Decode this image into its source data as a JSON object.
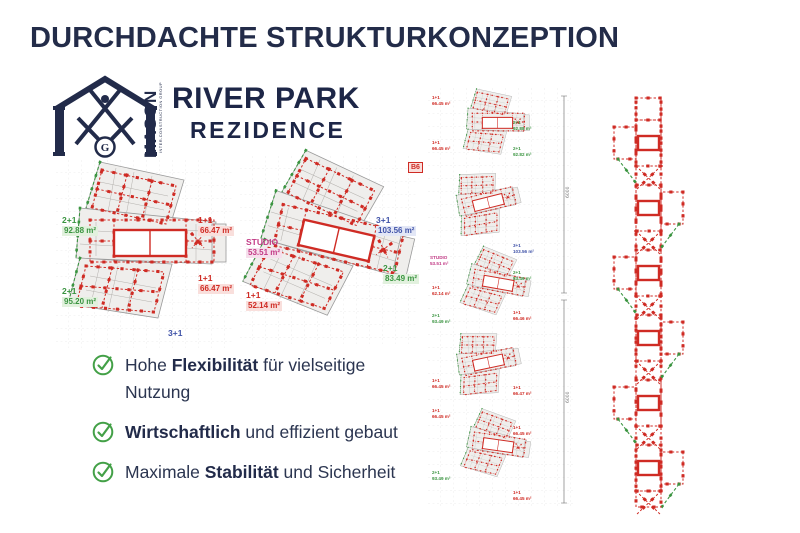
{
  "slide": {
    "title": "DURCHDACHTE STRUKTURKONZEPTION"
  },
  "logo": {
    "brand": "MASON",
    "tagline": "INTER-CONSTRUCTION GROUP",
    "emblem_letter": "G",
    "project": "RIVER PARK",
    "project_sub": "REZIDENCE"
  },
  "plans": {
    "left": {
      "labels": [
        {
          "unit": "2+1",
          "area": "92.88 m²"
        },
        {
          "unit": "1+1",
          "area": "66.47 m²"
        },
        {
          "unit": "2+1",
          "area": "95.20 m²"
        },
        {
          "unit": "1+1",
          "area": "66.47 m²"
        }
      ],
      "bottom_unit": "3+1"
    },
    "middle": {
      "badge": "B6",
      "labels": [
        {
          "unit": "3+1",
          "area": "103.56 m²"
        },
        {
          "unit": "STUDIO",
          "area": "53.51 m²"
        },
        {
          "unit": "2+1",
          "area": "83.49 m²"
        },
        {
          "unit": "1+1",
          "area": "52.14 m²"
        }
      ]
    }
  },
  "strip": {
    "labels": [
      {
        "text": "1+1\n66.45 m²"
      },
      {
        "text": "1+1\n66.45 m²"
      },
      {
        "text": "STUDIO\n53.51 m²"
      },
      {
        "text": "1+1\n62.14 m²"
      },
      {
        "text": "2+1\n93.49 m²"
      },
      {
        "text": "1+1\n66.45 m²"
      },
      {
        "text": "1+1\n66.45 m²"
      },
      {
        "text": "2+1\n93.49 m²"
      },
      {
        "text": "2+1\n92.88 m²"
      },
      {
        "text": "2+1\n92.82 m²"
      },
      {
        "text": "3+1\n103.56 m²"
      },
      {
        "text": "2+1\n83.49 m²"
      },
      {
        "text": "1+1\n66.46 m²"
      },
      {
        "text": "1+1\n66.47 m²"
      },
      {
        "text": "1+1\n66.45 m²"
      },
      {
        "text": "1+1\n66.45 m²"
      }
    ],
    "dimensions": [
      "6000",
      "6000"
    ]
  },
  "benefits": [
    {
      "pre": "Hohe ",
      "bold": "Flexibilität",
      "post": " für vielseitige Nutzung"
    },
    {
      "pre": "",
      "bold": "Wirtschaftlich",
      "post": " und effizient gebaut"
    },
    {
      "pre": "Maximale ",
      "bold": "Stabilität",
      "post": " und Sicherheit"
    }
  ],
  "colors": {
    "navy": "#222b4a",
    "red": "#cf2b24",
    "green": "#3a9440",
    "blue": "#4053a8",
    "magenta": "#c23a85",
    "check_green": "#43a047"
  }
}
